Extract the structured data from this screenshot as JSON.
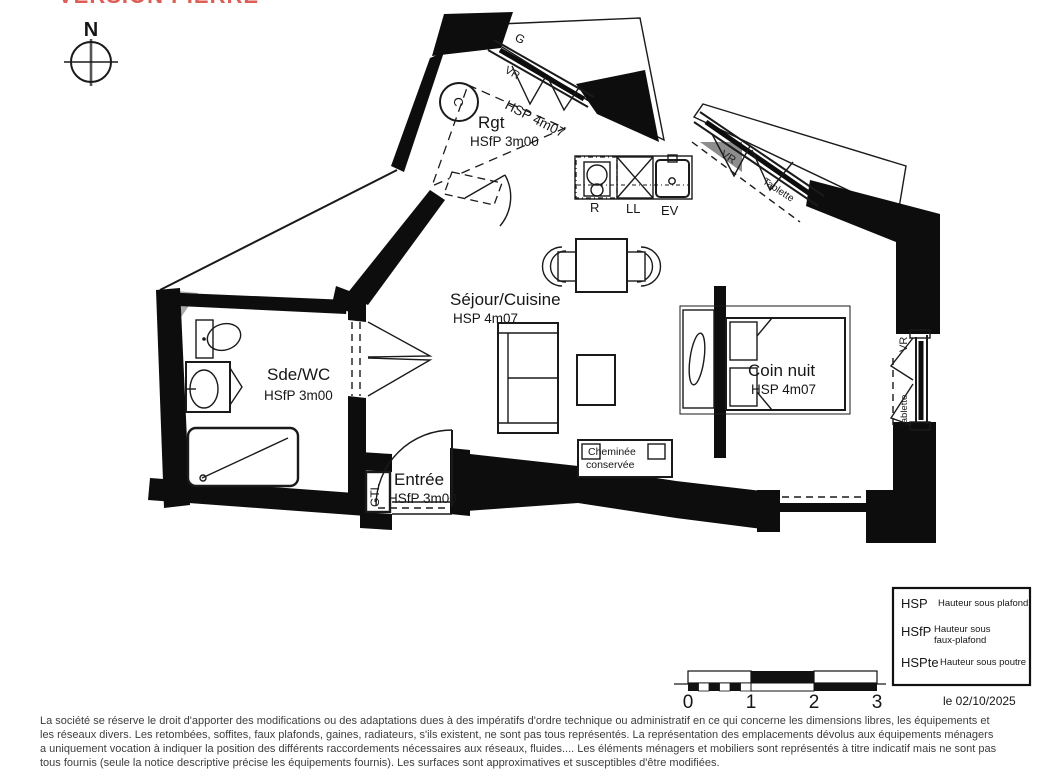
{
  "title": "VERSION PIERRE",
  "compass": {
    "north": "N"
  },
  "rooms": {
    "rgt": {
      "name": "Rgt",
      "ceiling": "HSfP 3m00",
      "zone": "HSP 4m07"
    },
    "sejour": {
      "name": "Séjour/Cuisine",
      "ceiling": "HSP 4m07"
    },
    "coin_nuit": {
      "name": "Coin nuit",
      "ceiling": "HSP 4m07"
    },
    "sde_wc": {
      "name": "Sde/WC",
      "ceiling": "HSfP 3m00"
    },
    "entree": {
      "name": "Entrée",
      "ceiling": "HSfP 3m00"
    }
  },
  "annotations": {
    "guardrail": "G",
    "vr_north": "VR",
    "vr_northeast": "VR",
    "tablette_northeast": "Tablette",
    "vr_east": "VR",
    "tablette_east": "Tablette",
    "flue": "C",
    "gtl": "GTL",
    "fridge": "R",
    "washer": "LL",
    "sink": "EV",
    "chimney_line1": "Cheminée",
    "chimney_line2": "conservée"
  },
  "legend": {
    "items": [
      {
        "abbr": "HSP",
        "label": "Hauteur sous plafond",
        "label2": ""
      },
      {
        "abbr": "HSfP",
        "label": "Hauteur sous",
        "label2": "faux-plafond"
      },
      {
        "abbr": "HSPte",
        "label": "Hauteur sous poutre",
        "label2": ""
      }
    ]
  },
  "scale_bar": {
    "ticks": [
      "0",
      "1",
      "2",
      "3"
    ]
  },
  "date": "le 02/10/2025",
  "disclaimer": "La société se réserve le droit d'apporter des modifications ou des adaptations dues à des impératifs d'ordre technique ou administratif en ce qui concerne les dimensions libres, les équipements et les réseaux divers. Les retombées, soffites, faux plafonds, gaines, radiateurs, s'ils existent, ne sont pas tous représentés. La représentation des emplacements dévolus aux équipements ménagers a uniquement vocation à indiquer la position des différents raccordements nécessaires aux réseaux, fluides.... Les éléments ménagers et mobiliers sont représentés à titre indicatif mais ne sont pas tous fournis (seule la notice descriptive précise les équipements fournis). Les surfaces sont approximatives et susceptibles d'être modifiées."
}
